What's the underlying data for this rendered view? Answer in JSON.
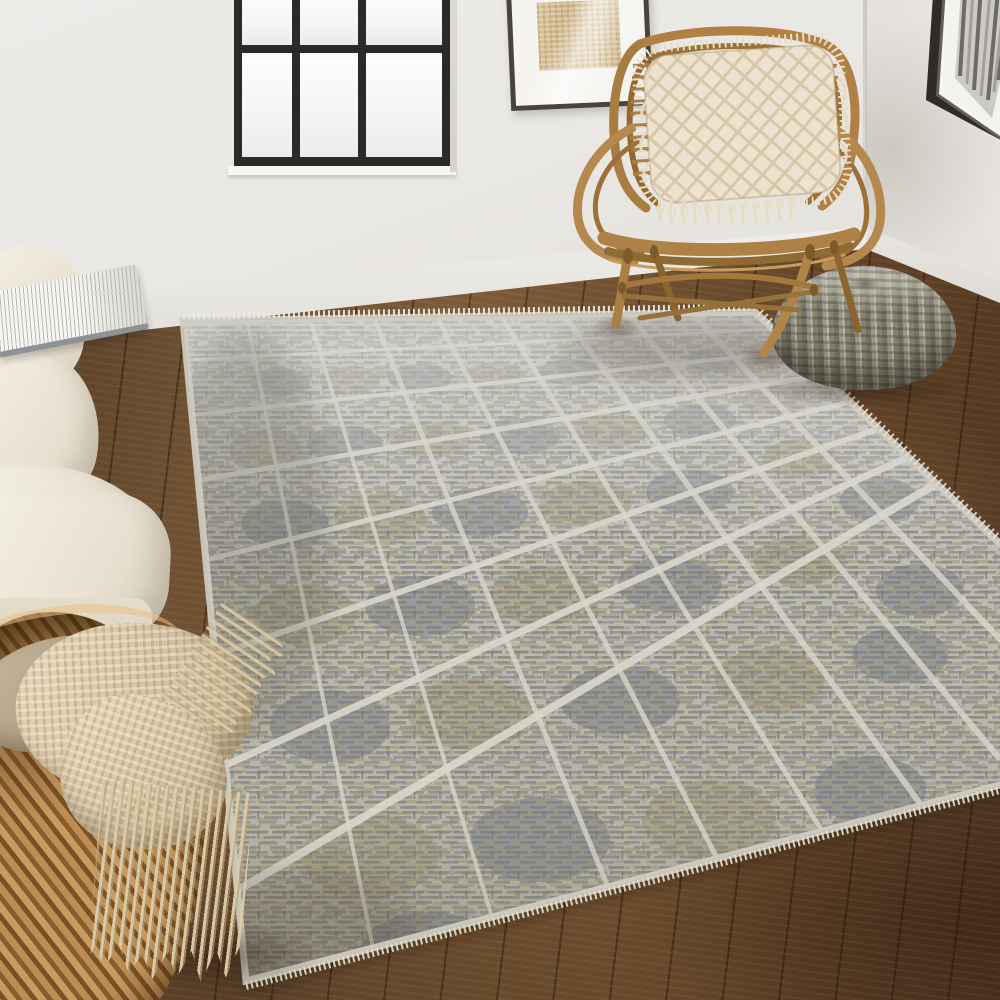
{
  "scene": {
    "setting": "Bright living-room corner with white walls, black-framed window and dark walnut wood floor",
    "focal_product": "Gray and taupe geometric maze-pattern area rug laid diagonally",
    "lighting": "Soft daylight from the left window",
    "window": {
      "frame_color": "#2b2a28",
      "glass": "frosted white",
      "visible_panes": 6,
      "columns": 3,
      "rows_visible": 2
    },
    "palette": {
      "wall": "#e9e7e3",
      "baseboard": "#f2f1ed",
      "floor_wood": "#6b4c2e",
      "rug_ivory": "#d8d5cb",
      "rug_slate": "#6e7580",
      "rug_taupe": "#a0957a",
      "rattan": "#b08044",
      "cream_fabric": "#ece4d2",
      "pouf_gray": "#8b887c",
      "basket_tan": "#b98c52",
      "blanket_beige": "#d9c8a6"
    },
    "objects": [
      {
        "id": "area-rug",
        "name": "Geometric area rug",
        "description": "Hand-knotted rug with ivory grid lines over square blocks of slate-gray and olive-taupe Greek-key maze texture; ivory bound edges with short fringe on the far side",
        "colors": [
          "#6e7580",
          "#a0957a",
          "#d8d5cb"
        ]
      },
      {
        "id": "rattan-chair",
        "name": "Rattan accent chair",
        "description": "Honey-toned bent rattan chair with rounded hoop back, horizontal cane slats, looped arms and splayed legs with cross stretchers",
        "colors": [
          "#b08044",
          "#8f6a33"
        ]
      },
      {
        "id": "boho-pillow",
        "name": "Fringed diamond-knit pillow",
        "description": "Cream textured pillow with raised diamond lattice and long fringe edges, resting on the rattan chair",
        "colors": [
          "#ece2ce",
          "#d7c6a8"
        ]
      },
      {
        "id": "knit-pouf",
        "name": "Chunky knit pouf",
        "description": "Round gray-taupe cable-knit floor pouf on the wood floor right of the chair",
        "colors": [
          "#8b887c",
          "#5e5c51"
        ]
      },
      {
        "id": "sofa",
        "name": "Cream linen sofa",
        "description": "Partial view of a light beige upholstered sofa back, seat and rolled arm at the left edge",
        "colors": [
          "#ece4d2"
        ]
      },
      {
        "id": "book",
        "name": "Open book",
        "description": "Open white-paged book resting on the sofa back",
        "colors": [
          "#f7f6f2",
          "#8e9296"
        ]
      },
      {
        "id": "seagrass-basket",
        "name": "Woven seagrass basket",
        "description": "Golden-tan handwoven basket in the bottom-left corner holding textiles",
        "colors": [
          "#b98c52",
          "#7b5026"
        ]
      },
      {
        "id": "throw-blanket",
        "name": "Fringed throw blanket",
        "description": "Beige waffle-knit throw with long tasseled fringe draped over the basket rim",
        "colors": [
          "#d9c8a6",
          "#bcaa86"
        ]
      },
      {
        "id": "window",
        "name": "Black grid window",
        "description": "Black metal-framed window with frosted white panes, partially cropped at the top left",
        "colors": [
          "#2b2a28",
          "#fdfdfc"
        ]
      },
      {
        "id": "art-left",
        "name": "Framed tan abstract art",
        "description": "Dark-framed artwork with white mat and beige woven-texture print, top center, cropped by image top",
        "colors": [
          "#49433c",
          "#ccb184"
        ]
      },
      {
        "id": "art-right",
        "name": "Framed gray abstract art",
        "description": "Black-framed artwork with white mat and gray vertical-streak print on the right wall, cropped by image edge",
        "colors": [
          "#2e2b28",
          "#8d8a85"
        ]
      },
      {
        "id": "wood-floor",
        "name": "Walnut plank floor",
        "description": "Dark brown wood flooring with visible grain and plank seams",
        "colors": [
          "#6b4c2e"
        ]
      },
      {
        "id": "walls",
        "name": "White walls",
        "description": "Soft white walls meeting in a corner at the upper right",
        "colors": [
          "#e9e7e3"
        ]
      },
      {
        "id": "baseboard",
        "name": "White baseboard",
        "description": "White baseboard trim along the bottom of both walls",
        "colors": [
          "#f2f1ed"
        ]
      }
    ]
  }
}
